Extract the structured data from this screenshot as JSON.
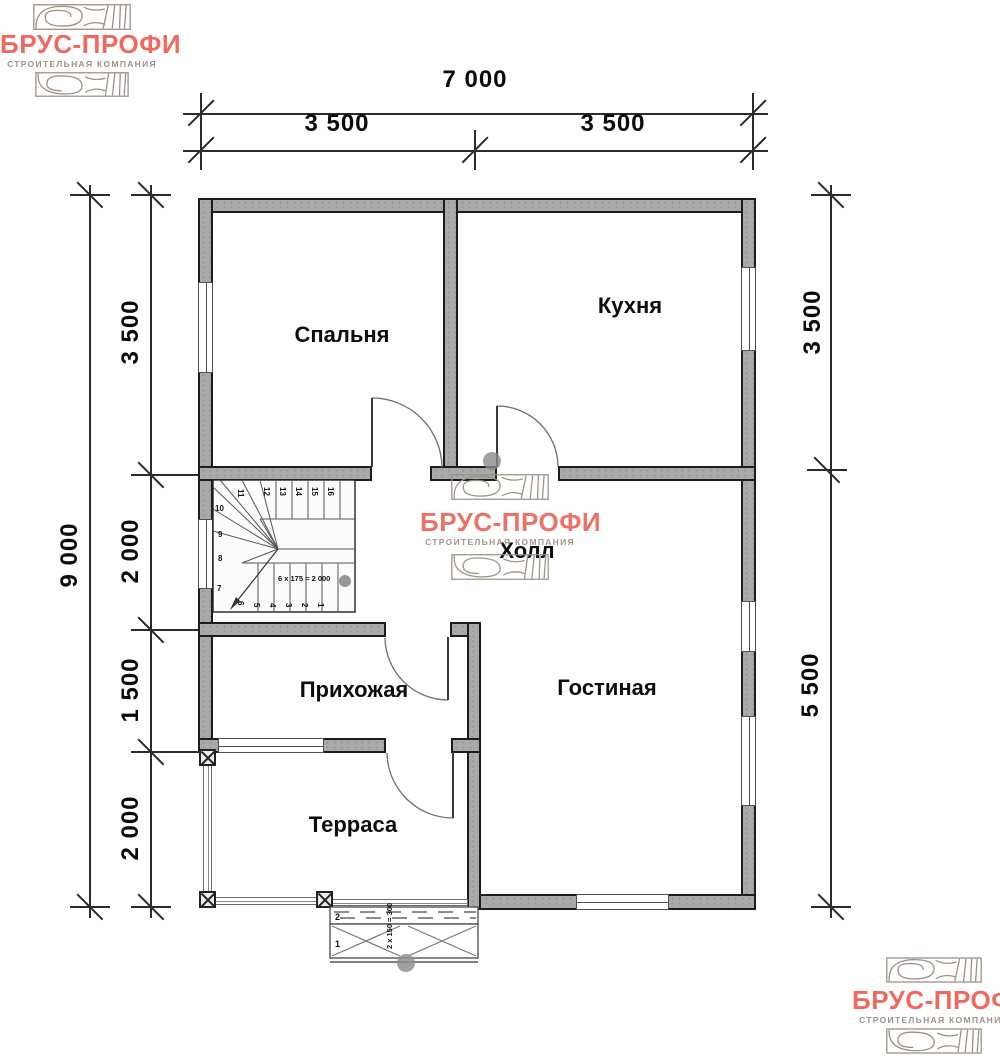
{
  "logo": {
    "title": "БРУС-ПРОФИ",
    "subtitle": "СТРОИТЕЛЬНАЯ КОМПАНИЯ",
    "accent_color": "#ee6a5f",
    "subtitle_color": "#9b9188"
  },
  "dimensions": {
    "top_total": "7 000",
    "top_left": "3 500",
    "top_right": "3 500",
    "left_total": "9 000",
    "left_segments": [
      "3 500",
      "2 000",
      "1 500",
      "2 000"
    ],
    "right_segments": [
      "3 500",
      "5 500"
    ]
  },
  "rooms": {
    "bedroom": "Спальня",
    "kitchen": "Кухня",
    "hall": "Холл",
    "entry": "Прихожая",
    "living": "Гостиная",
    "terrace": "Терраса"
  },
  "stairs": {
    "top_numbers": [
      "11",
      "12",
      "13",
      "14",
      "15",
      "16"
    ],
    "left_numbers": [
      "10",
      "9",
      "8",
      "7"
    ],
    "bottom_numbers": [
      "6",
      "5",
      "4",
      "3",
      "2",
      "1"
    ],
    "note": "6 х 175 = 2 000"
  },
  "porch": {
    "step_numbers": [
      "2",
      "1"
    ],
    "note": "2 х 150 = 300"
  }
}
